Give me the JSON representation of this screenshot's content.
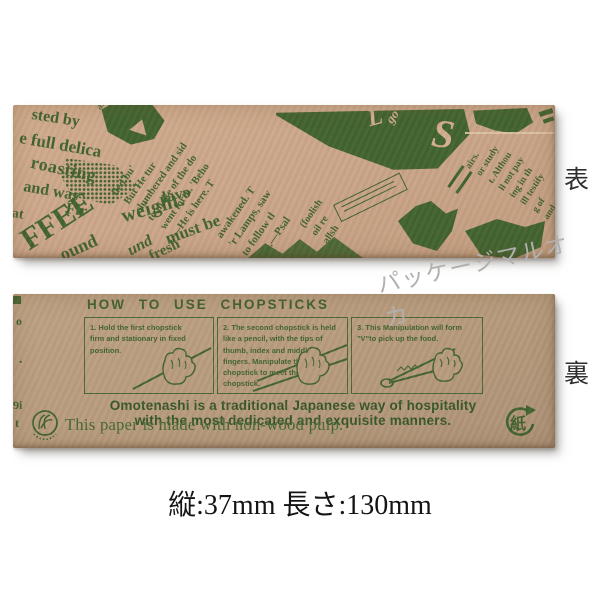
{
  "labels": {
    "front": "表",
    "back": "裏"
  },
  "caption": "縦:37mm 長さ:130mm",
  "watermark": "パッケージマルオカ",
  "colors": {
    "kraft_front": "#cba689",
    "kraft_back": "#b79b7d",
    "ink_green": "#41632f",
    "ink_dark_green": "#37562a",
    "watermark_gray": "#b2b0ae"
  },
  "front": {
    "masthead": [
      "sted by",
      "e full delica",
      "roasting",
      "and was",
      "Fir",
      "at"
    ],
    "coffee": "FFEE",
    "words": [
      "und",
      "fresh",
      "ound",
      "must be",
      "weight.",
      "lavo"
    ],
    "light_glyphs": [
      "L",
      "go",
      "S"
    ],
    "col_left": [
      "are",
      "world",
      "God's",
      "In this"
    ],
    "col_mid_a": [
      "fled bu'",
      "But He tur",
      "slumbered and sid",
      "to make of the do",
      "went forth. 'Beho",
      "—He is here. T"
    ],
    "col_mid_b": [
      "awakened. T",
      "'r Lamps, saw",
      "to follow tl",
      "'lage.—Psal"
    ],
    "col_small": [
      "(foolish",
      "oil re",
      "allsh"
    ],
    "col_right": [
      "airs.",
      "or study",
      "t. Althou",
      "ll not pay",
      "ing in th",
      "ill testify",
      "g of",
      "and"
    ]
  },
  "back": {
    "title": "HOW TO USE CHOPSTICKS",
    "steps": [
      {
        "num": "1.",
        "text": "Hold the first chopstick firm and stationary in fixed position."
      },
      {
        "num": "2.",
        "text": "The second chopstick is held like a pencil, with the tips of thumb, index and middle fingers. Manipulate this chopstick to meet the first chopstick."
      },
      {
        "num": "3.",
        "text": "This Manipulation will form \"V\"to pick up the food."
      }
    ],
    "message_line1": "Omotenashi is a traditional Japanese way of hospitality",
    "message_line2": "with the most dedicated and exquisite manners.",
    "pulp_note": "This paper is made with non-wood pulp.",
    "recycle_kanji": "紙",
    "edge_fragments": [
      "o",
      "H",
      ".",
      "9i",
      "t"
    ]
  }
}
